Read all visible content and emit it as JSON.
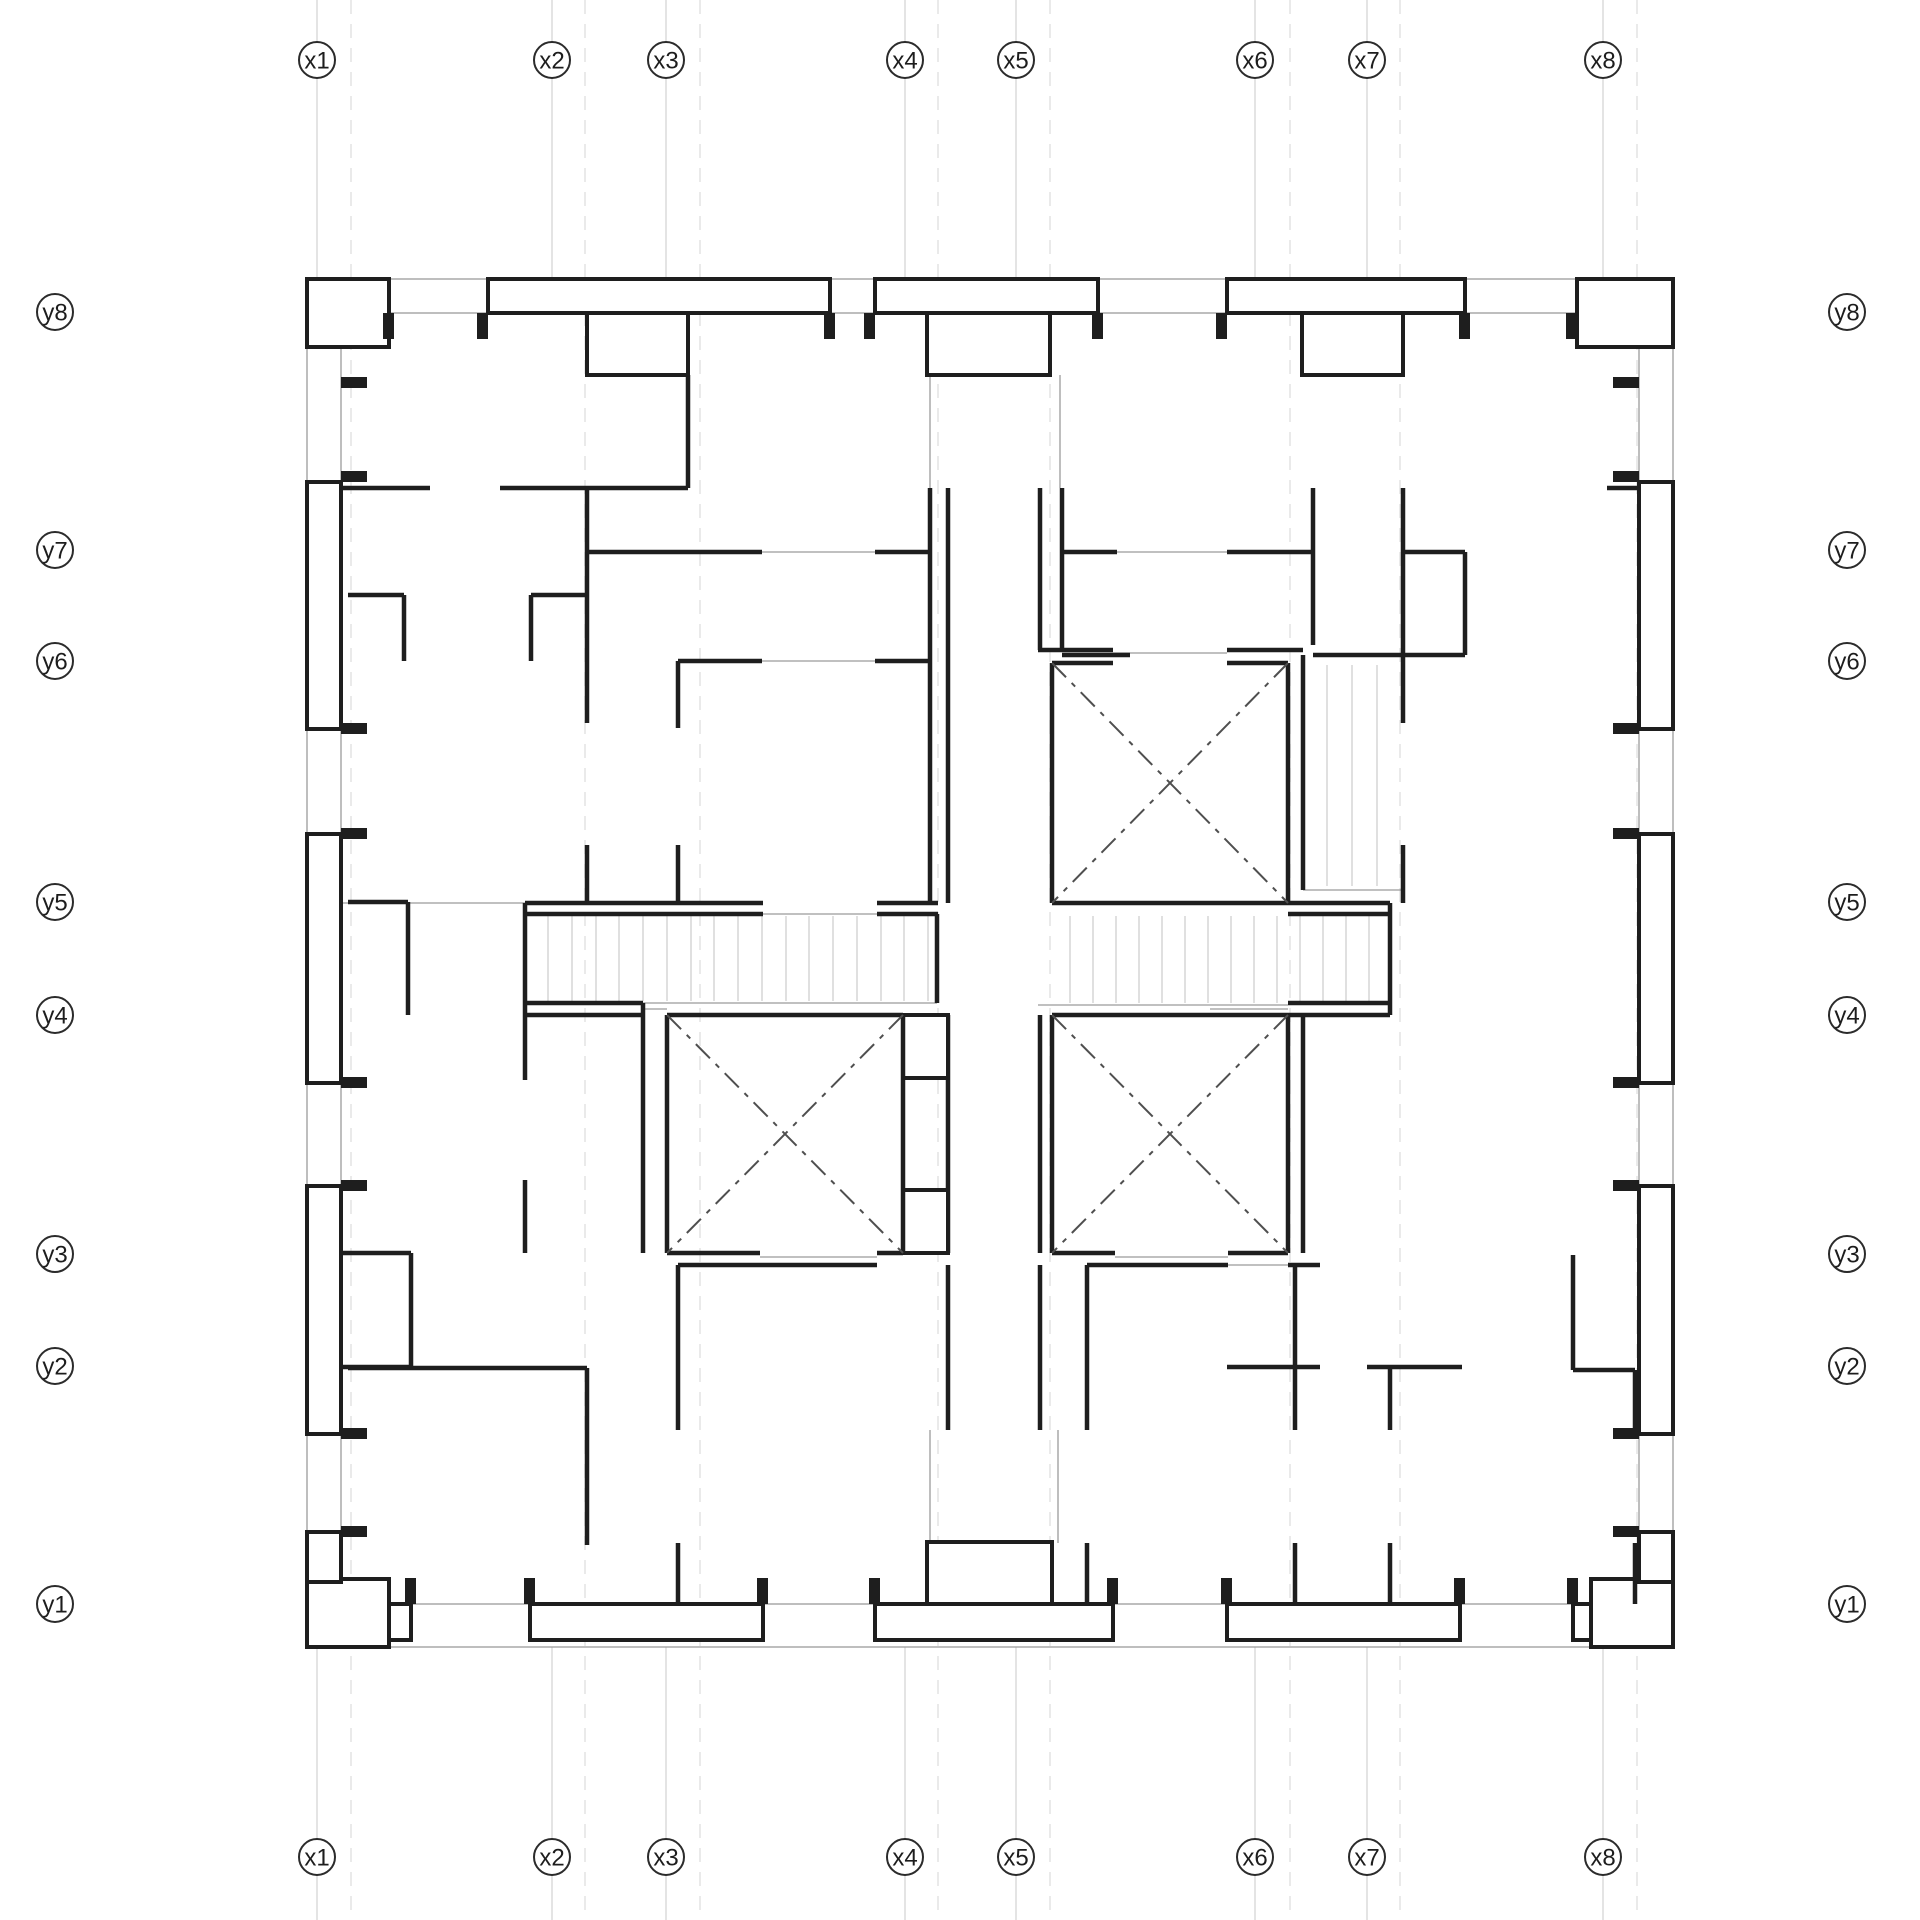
{
  "axes": {
    "x_labels": [
      "x1",
      "x2",
      "x3",
      "x4",
      "x5",
      "x6",
      "x7",
      "x8"
    ],
    "y_labels": [
      "y8",
      "y7",
      "y6",
      "y5",
      "y4",
      "y3",
      "y2",
      "y1"
    ]
  },
  "colors": {
    "wall": "#1e1e1e",
    "thin": "#9b9b9b",
    "grid": "#c9c9c9",
    "grid2": "#dcdcdc",
    "tread": "#c6c6c6",
    "diag": "#4f4f4f",
    "label": "#1d1d1d",
    "paper": "#ffffff"
  }
}
